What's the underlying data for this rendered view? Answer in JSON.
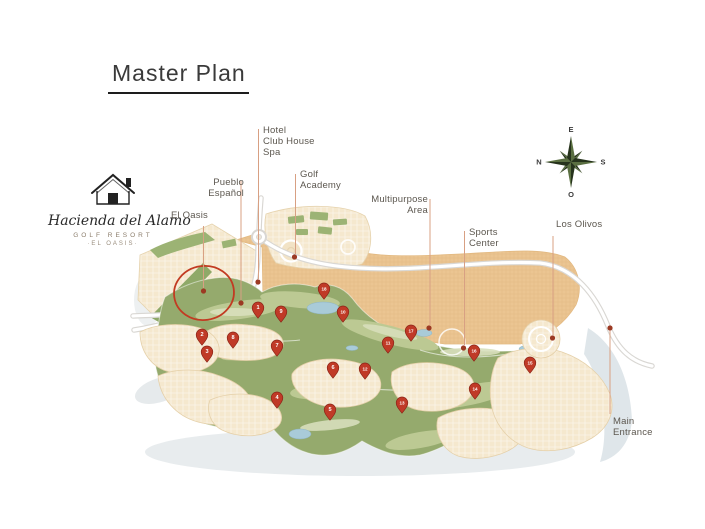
{
  "title": "Master Plan",
  "logo": {
    "brand": "Hacienda del Alamo",
    "subtitle": "GOLF RESORT",
    "tagline": "·EL OASIS·"
  },
  "compass": {
    "top": "E",
    "right": "S",
    "bottom": "O",
    "left": "N"
  },
  "map_labels": [
    {
      "id": "el-oasis",
      "lines": [
        "El Oasis"
      ],
      "x": 171,
      "y": 210,
      "w": 50,
      "align": "left",
      "line": {
        "x": 203.5,
        "y1": 226,
        "y2": 288
      },
      "dot": {
        "x": 203.5,
        "y": 291
      }
    },
    {
      "id": "pueblo-espanol",
      "lines": [
        "Pueblo",
        "Español"
      ],
      "x": 194,
      "y": 177,
      "w": 50,
      "align": "right",
      "line": {
        "x": 241,
        "y1": 181,
        "y2": 300
      },
      "dot": {
        "x": 241,
        "y": 303
      }
    },
    {
      "id": "hotel-club-house-spa",
      "lines": [
        "Hotel",
        "Club House",
        "Spa"
      ],
      "x": 263,
      "y": 125,
      "w": 62,
      "align": "left",
      "line": {
        "x": 258.5,
        "y1": 129,
        "y2": 279
      },
      "dot": {
        "x": 258,
        "y": 282
      }
    },
    {
      "id": "golf-academy",
      "lines": [
        "Golf",
        "Academy"
      ],
      "x": 300,
      "y": 169,
      "w": 60,
      "align": "left",
      "line": {
        "x": 295.5,
        "y1": 174,
        "y2": 254
      },
      "dot": {
        "x": 294.5,
        "y": 257
      }
    },
    {
      "id": "multipurpose-area",
      "lines": [
        "Multipurpose",
        "Area"
      ],
      "x": 352,
      "y": 194,
      "w": 76,
      "align": "right",
      "line": {
        "x": 430,
        "y1": 199,
        "y2": 325
      },
      "dot": {
        "x": 429,
        "y": 328
      }
    },
    {
      "id": "sports-center",
      "lines": [
        "Sports",
        "Center"
      ],
      "x": 469,
      "y": 227,
      "w": 55,
      "align": "left",
      "line": {
        "x": 464.5,
        "y1": 231,
        "y2": 345
      },
      "dot": {
        "x": 463.5,
        "y": 348
      }
    },
    {
      "id": "los-olivos",
      "lines": [
        "Los Olivos"
      ],
      "x": 556,
      "y": 219,
      "w": 60,
      "align": "left",
      "line": {
        "x": 553,
        "y1": 236,
        "y2": 335
      },
      "dot": {
        "x": 552.5,
        "y": 338
      }
    },
    {
      "id": "main-entrance",
      "lines": [
        "Main",
        "Entrance"
      ],
      "x": 613,
      "y": 416,
      "w": 60,
      "align": "left",
      "line": {
        "x": 610,
        "y1": 331,
        "y2": 414
      },
      "dot": {
        "x": 610,
        "y": 328
      }
    }
  ],
  "pins": [
    {
      "n": "1",
      "x": 258,
      "y": 310
    },
    {
      "n": "2",
      "x": 202,
      "y": 337
    },
    {
      "n": "3",
      "x": 207,
      "y": 354
    },
    {
      "n": "4",
      "x": 277,
      "y": 400
    },
    {
      "n": "5",
      "x": 330,
      "y": 412
    },
    {
      "n": "6",
      "x": 333,
      "y": 370
    },
    {
      "n": "7",
      "x": 277,
      "y": 348
    },
    {
      "n": "8",
      "x": 233,
      "y": 340
    },
    {
      "n": "9",
      "x": 281,
      "y": 314
    },
    {
      "n": "10",
      "x": 343,
      "y": 314
    },
    {
      "n": "11",
      "x": 388,
      "y": 345
    },
    {
      "n": "12",
      "x": 365,
      "y": 371
    },
    {
      "n": "13",
      "x": 402,
      "y": 405
    },
    {
      "n": "14",
      "x": 475,
      "y": 391
    },
    {
      "n": "15",
      "x": 530,
      "y": 365
    },
    {
      "n": "16",
      "x": 474,
      "y": 353
    },
    {
      "n": "17",
      "x": 411,
      "y": 333
    },
    {
      "n": "18",
      "x": 324,
      "y": 291
    }
  ],
  "colors": {
    "pin_fill": "#C03A27",
    "pin_stroke": "#8A2417",
    "leader_line": "#D8A083",
    "leader_dot": "#9C3A23",
    "highlight_circle": "#C23B22",
    "label_text": "#5C574F",
    "course_green": "#95AA6D",
    "housing_beige": "#F5E8CE",
    "tan_area": "#EBC592"
  }
}
